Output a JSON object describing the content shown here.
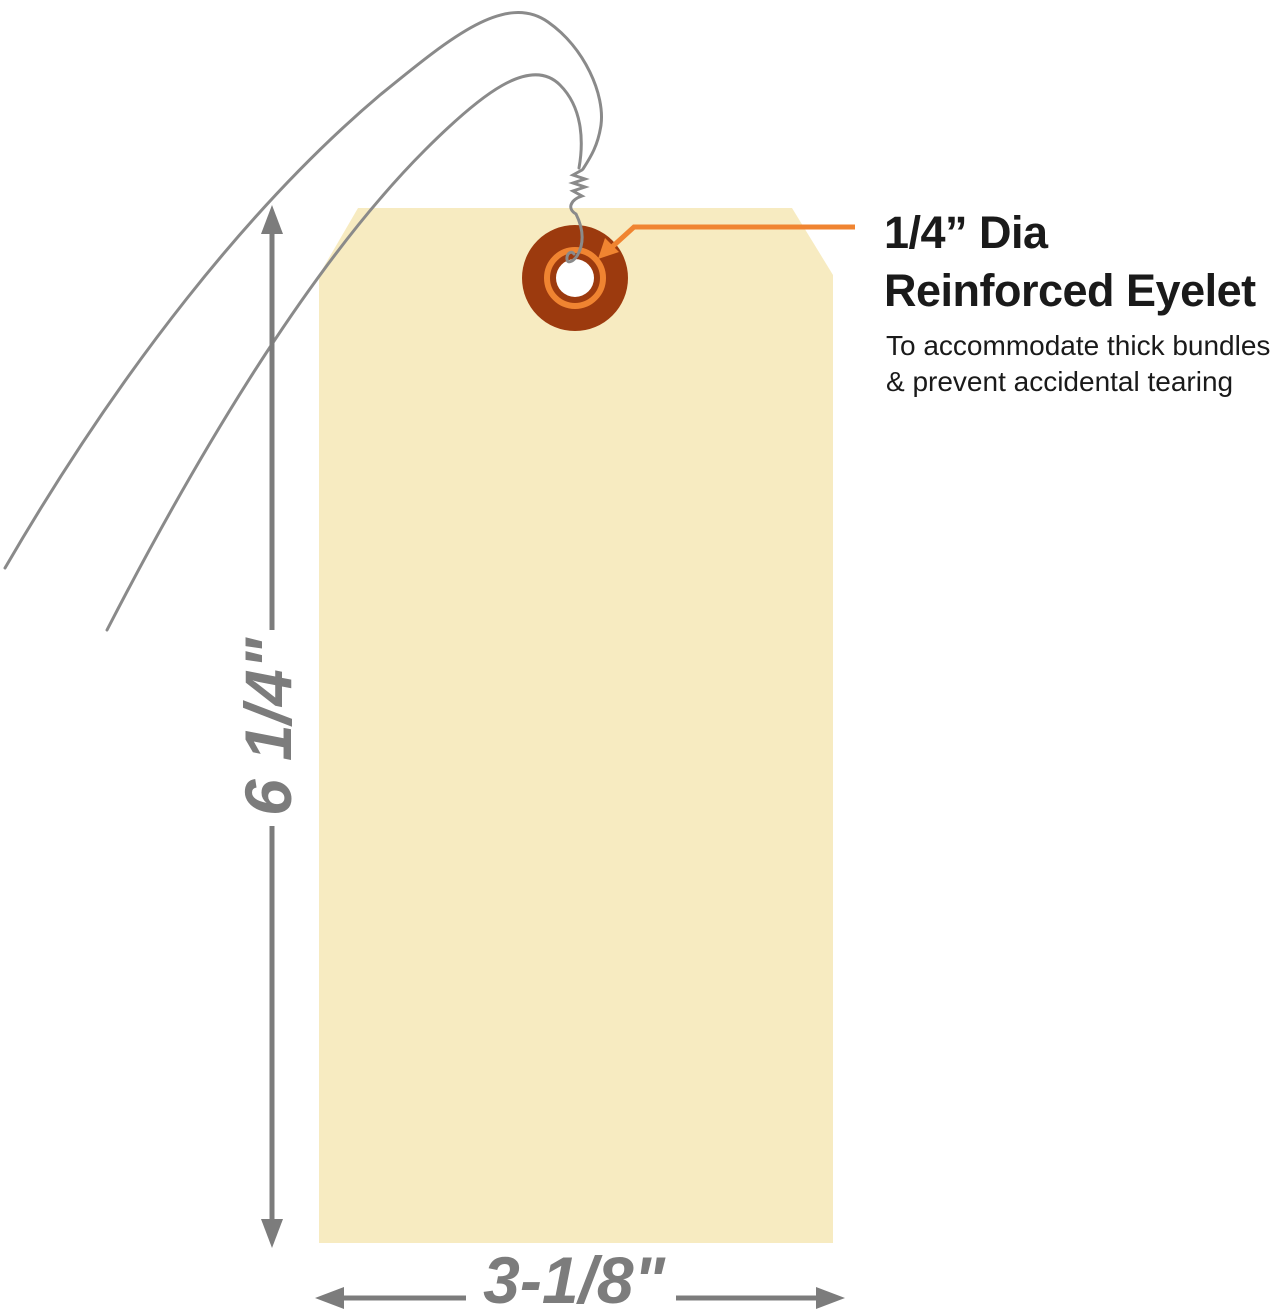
{
  "callout": {
    "title_line1": "1/4” Dia",
    "title_line2": "Reinforced Eyelet",
    "desc_line1": "To accommodate thick bundles",
    "desc_line2": "& prevent accidental tearing"
  },
  "dimensions": {
    "height_label": "6 1/4\"",
    "width_label": "3-1/8\""
  },
  "colors": {
    "tag_fill": "#F7EBC1",
    "eyelet_rust": "#9C3A0E",
    "accent_orange": "#F08431",
    "dimension_gray": "#7C7C7C",
    "wire_gray": "#8A8A8A",
    "text_black": "#1A1A1A",
    "hole_white": "#FFFFFF"
  }
}
